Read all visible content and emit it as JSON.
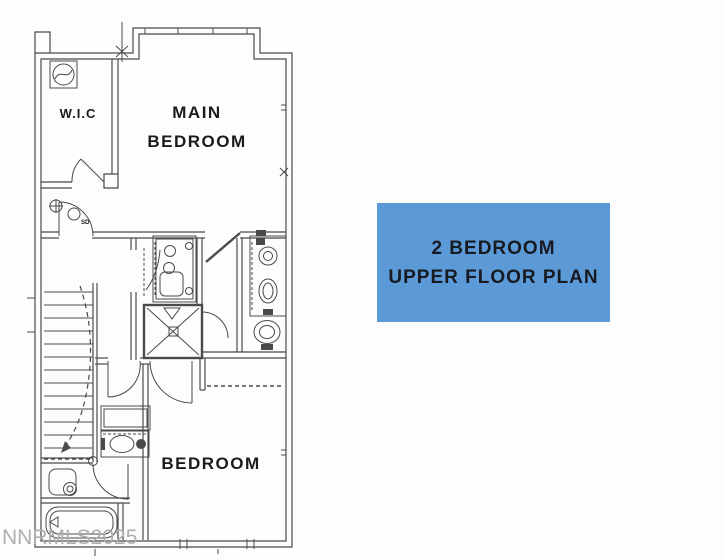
{
  "page": {
    "background_color": "#fdfdfd"
  },
  "plan": {
    "line_color": "#4a4a4a",
    "labels": {
      "wic": "W.I.C",
      "main_bedroom_line1": "MAIN",
      "main_bedroom_line2": "BEDROOM",
      "second_bedroom": "BEDROOM",
      "smoke_detector_abbr": "SD"
    }
  },
  "info_card": {
    "line1": "2 BEDROOM",
    "line2": "UPPER FLOOR PLAN",
    "background_color": "#5b9ad7",
    "text_color": "#181a22"
  },
  "watermark": {
    "text": "NNRMLS2025",
    "color": "#aeaeae"
  }
}
